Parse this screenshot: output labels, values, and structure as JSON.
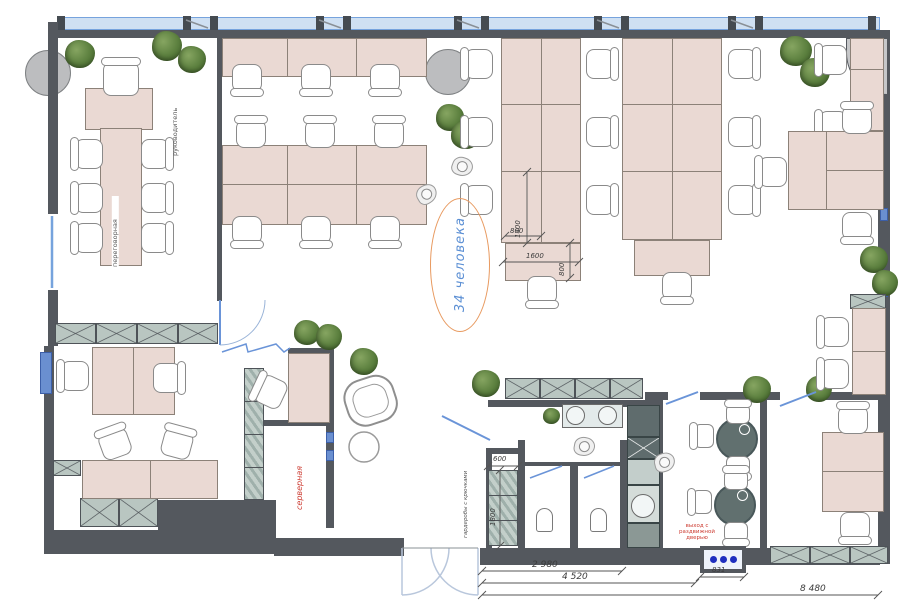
{
  "meta": {
    "title": "Office floor plan"
  },
  "labels": {
    "capacity": "34 человека",
    "meeting_room": "переговорная",
    "manager": "руководитель",
    "server_room": "серверная",
    "wardrobe": "гардеробы с крючками",
    "exit_note": "выход с раздвижной дверью"
  },
  "dimensions": {
    "row_depth": "1400",
    "desk_width": "800",
    "end_desk_width": "1600",
    "end_desk_depth": "800",
    "wardrobe_depth": "600",
    "wardrobe_length": "1800",
    "entry_width": "2 980",
    "wc_block_width": "4 520",
    "sign_width": "831",
    "total_width": "8 480"
  },
  "colors": {
    "wall": "#54585e",
    "desk": "#ead9d3",
    "window": "#cfe0f2",
    "window_frame": "#76a3dd",
    "cabinet": "#b9c6c1",
    "accent_orange": "#e89a60",
    "accent_blue": "#5b8fd4",
    "accent_red": "#cc3a30",
    "tree": "#5b7f3e"
  }
}
